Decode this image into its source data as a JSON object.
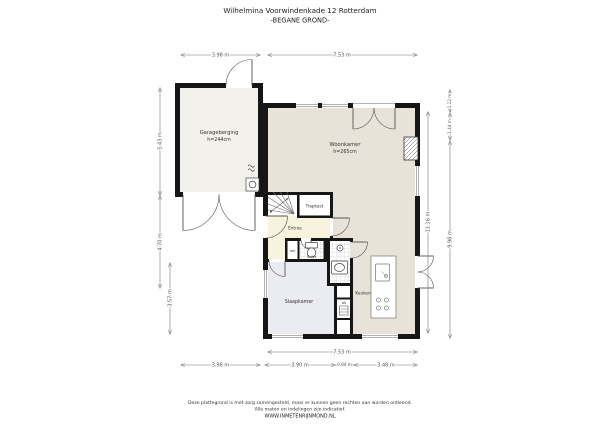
{
  "header": {
    "address": "Wilhelmina Voorwindenkade 12 Rotterdam",
    "floor": "-BEGANE GROND-"
  },
  "rooms": {
    "garage": {
      "name": "Garageberging",
      "ceiling": "h=244cm"
    },
    "living": {
      "name": "Woonkamer",
      "ceiling": "h=265cm"
    },
    "stairs_closet": {
      "name": "Trapkast"
    },
    "hall": {
      "name": "Entree"
    },
    "toilet": {
      "name": "Toilet"
    },
    "meter_cupboard": {
      "name": "mk"
    },
    "bedroom": {
      "name": "Slaapkamer"
    },
    "kitchen": {
      "name": "Keuken"
    },
    "cupboard": {
      "name": "ak"
    }
  },
  "dimensions": {
    "top_garage": "3.98 m",
    "top_living": "7.53 m",
    "bottom_overall": "7.53 m",
    "bottom_garage": "3.98 m",
    "bottom_seg1": "3.90 m",
    "bottom_seg2": "0.84 m",
    "bottom_seg3": "3.48 m",
    "left_garage": "5.43 m",
    "left_mid": "4.70 m",
    "left_bedroom": "3.57 m",
    "right_overall": "11.16 m",
    "right_seg1": "1.12 m",
    "right_seg2": "1.44 m",
    "right_seg3": "9.98 m"
  },
  "footer": {
    "disclaimer1": "Deze plattegrond is met zorg samengesteld, maar er kunnen geen rechten aan worden ontleend.",
    "disclaimer2": "Alle maten en indelingen zijn indicatief.",
    "website": "WWW.INMETENRIJNMOND.NL"
  },
  "colors": {
    "wall": "#161616",
    "floor_garage": "#f2f1eb",
    "floor_living": "#e8e2d9",
    "floor_hall": "#f7f3dd",
    "floor_bedroom": "#ebebf2",
    "dimension": "#777777"
  }
}
